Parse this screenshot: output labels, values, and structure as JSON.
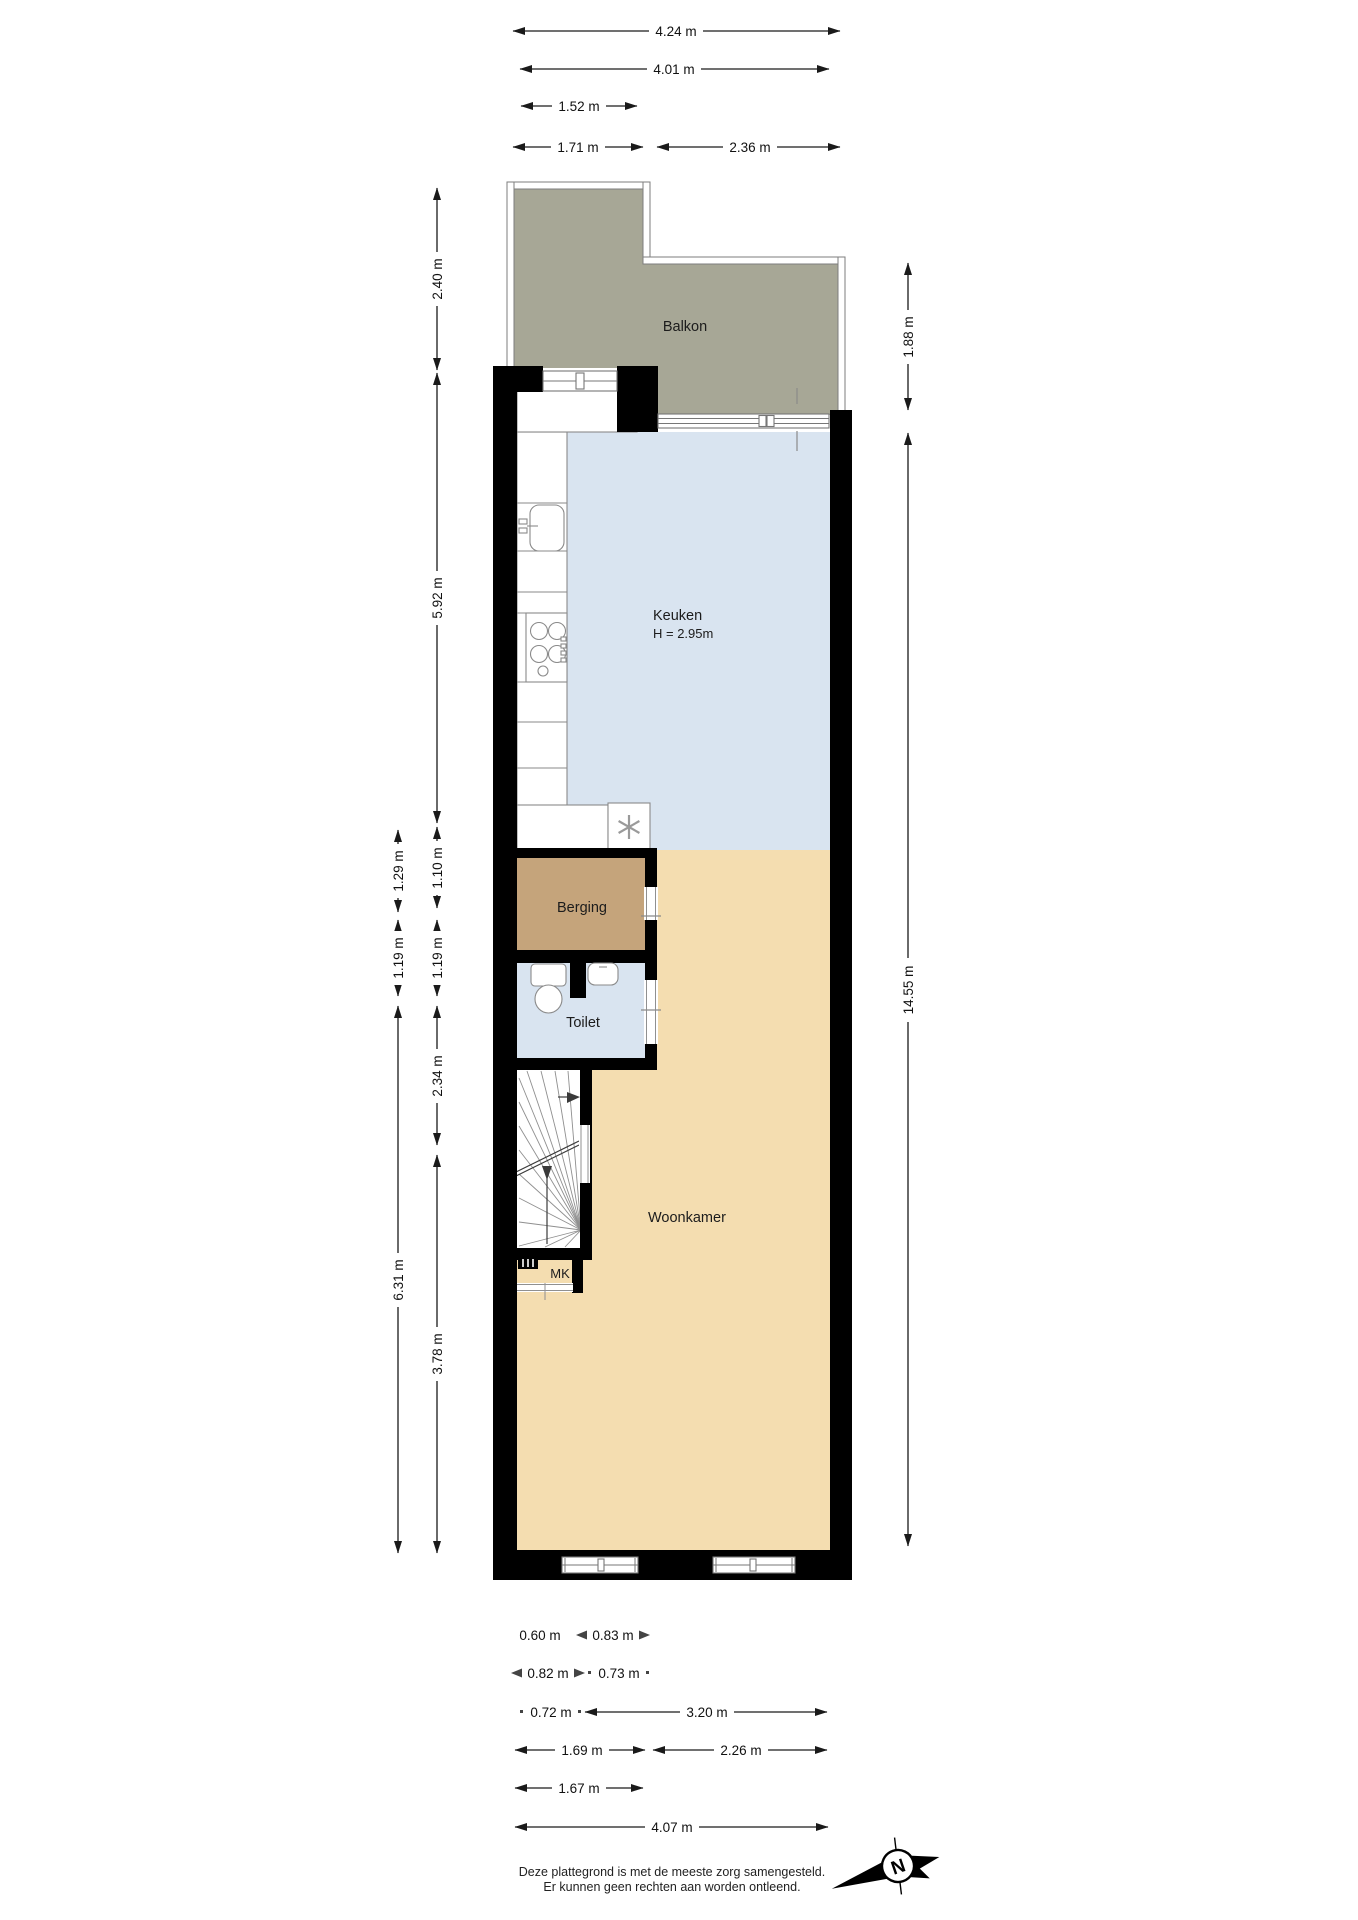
{
  "rooms": {
    "balkon": "Balkon",
    "keuken": "Keuken",
    "keuken_height": "H = 2.95m",
    "berging": "Berging",
    "toilet": "Toilet",
    "woonkamer": "Woonkamer",
    "mk": "MK"
  },
  "dimensions": {
    "top": [
      "4.24 m",
      "4.01 m",
      "1.52 m",
      "1.71 m",
      "2.36 m"
    ],
    "left_outer": [
      "1.29 m",
      "1.19 m",
      "6.31 m"
    ],
    "left_inner": [
      "2.40 m",
      "5.92 m",
      "1.10 m",
      "1.19 m",
      "2.34 m",
      "3.78 m"
    ],
    "right": [
      "1.88 m",
      "14.55 m"
    ],
    "bottom": [
      "0.60 m",
      "0.83 m",
      "0.82 m",
      "0.73 m",
      "0.72 m",
      "3.20 m",
      "1.69 m",
      "2.26 m",
      "1.67 m",
      "4.07 m"
    ]
  },
  "footer": {
    "disclaimer_line1": "Deze plattegrond is met de meeste zorg samengesteld.",
    "disclaimer_line2": "Er kunnen geen rechten aan worden ontleend."
  },
  "compass": {
    "north_label": "N"
  },
  "colors": {
    "wall": "#000000",
    "balcony_floor": "#a7a796",
    "kitchen_floor": "#d9e4f0",
    "living_floor": "#f4ddb0",
    "storage_floor": "#c5a47b"
  }
}
